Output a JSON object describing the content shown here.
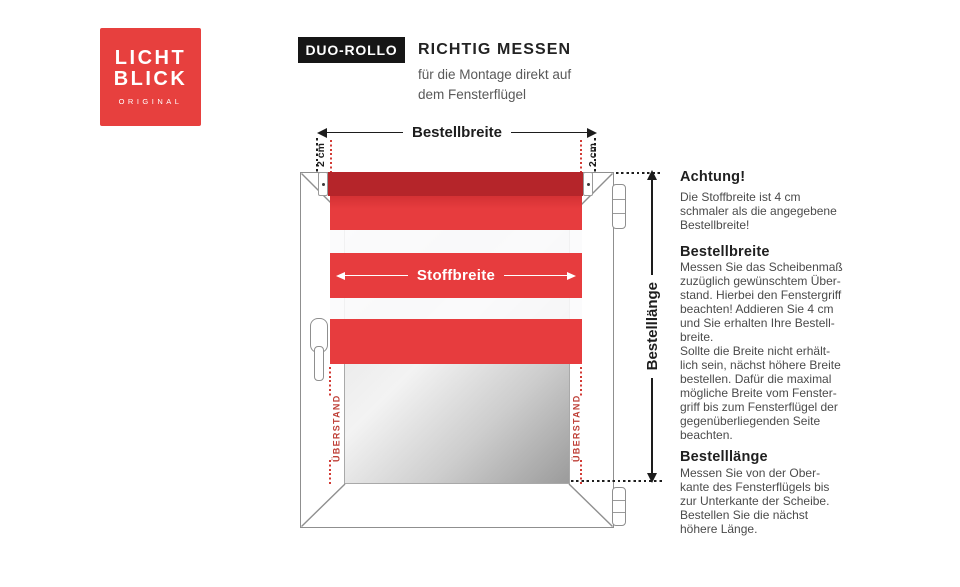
{
  "brand": {
    "name_line1": "LICHT",
    "name_line2": "BLICK",
    "tagline": "ORIGINAL"
  },
  "header": {
    "badge": "DUO-ROLLO",
    "title": "RICHTIG MESSEN",
    "subtitle": [
      "für die Montage direkt auf",
      "dem Fensterflügel"
    ]
  },
  "diagram": {
    "labels": {
      "order_width": "Bestellbreite",
      "fabric_width": "Stoffbreite",
      "order_length": "Bestelllänge",
      "offset_left": "2 cm",
      "offset_right": "2 cm",
      "overhang_left": "ÜBERSTAND",
      "overhang_right": "ÜBERSTAND"
    },
    "colors": {
      "logo_red": "#e7403e",
      "fabric_red": "#e73c3e",
      "tube_red": "#b5252a",
      "dotted_red": "#d23a34",
      "overhang_text_red": "#bf4038"
    }
  },
  "instructions": {
    "sections": [
      {
        "heading": "Achtung!",
        "lines": [
          "Die Stoffbreite ist 4 cm",
          "schmaler als die angegebene",
          "Bestellbreite!"
        ]
      },
      {
        "heading": "Bestellbreite",
        "lines": [
          "Messen Sie das Scheibenmaß",
          "zuzüglich gewünschtem Über-",
          "stand. Hierbei den Fenstergriff",
          "beachten! Addieren Sie 4 cm",
          "und Sie erhalten Ihre Bestell-",
          "breite.",
          "Sollte die Breite nicht erhält-",
          "lich sein, nächst höhere Breite",
          "bestellen. Dafür die maximal",
          "mögliche Breite vom Fenster-",
          "griff bis zum Fensterflügel der",
          "gegenüberliegenden Seite",
          "beachten."
        ]
      },
      {
        "heading": "Bestelllänge",
        "lines": [
          "Messen Sie von der Ober-",
          "kante des Fensterflügels bis",
          "zur Unterkante der Scheibe.",
          "Bestellen Sie die nächst",
          "höhere Länge."
        ]
      }
    ]
  }
}
